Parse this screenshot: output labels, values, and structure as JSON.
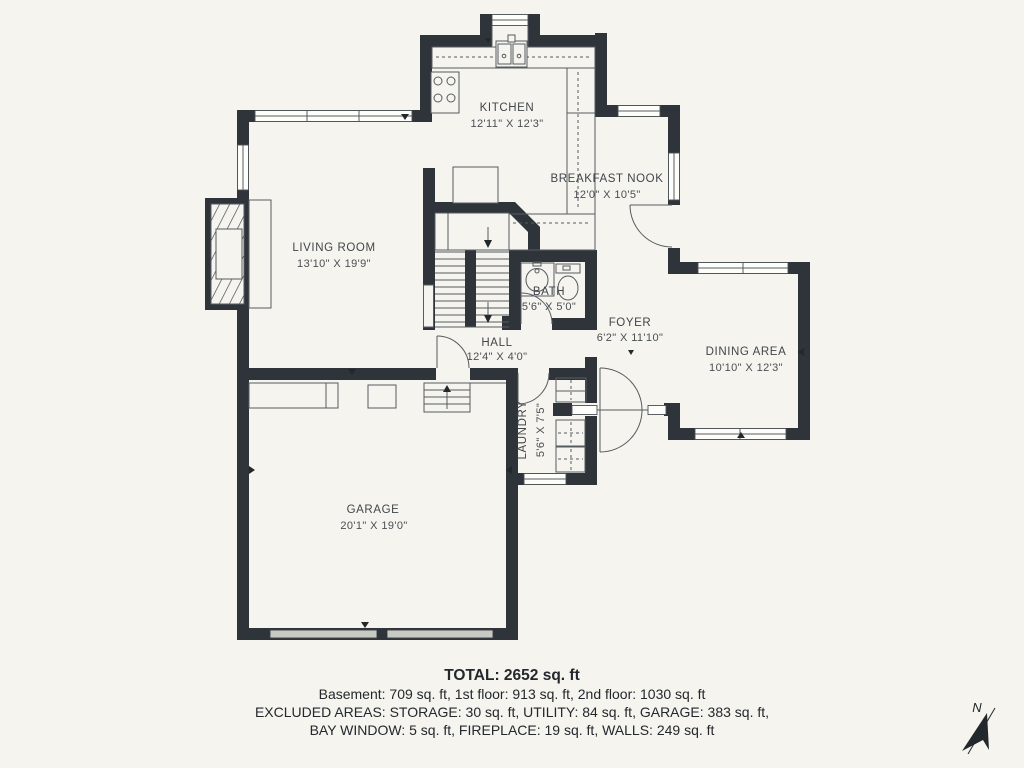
{
  "colors": {
    "background": "#f5f4ee",
    "walls": "#2f343a",
    "thin_lines": "#565b60",
    "text": "#41464b",
    "garage_door": "#c9c9c3"
  },
  "rooms": {
    "kitchen": {
      "name": "KITCHEN",
      "dims": "12'11\" X 12'3\""
    },
    "breakfast_nook": {
      "name": "BREAKFAST NOOK",
      "dims": "12'0\" X 10'5\""
    },
    "living_room": {
      "name": "LIVING ROOM",
      "dims": "13'10\" X 19'9\""
    },
    "bath": {
      "name": "BATH",
      "dims": "5'6\" X 5'0\""
    },
    "hall": {
      "name": "HALL",
      "dims": "12'4\" X 4'0\""
    },
    "foyer": {
      "name": "FOYER",
      "dims": "6'2\" X 11'10\""
    },
    "dining_area": {
      "name": "DINING AREA",
      "dims": "10'10\" X 12'3\""
    },
    "laundry": {
      "name": "LAUNDRY",
      "dims": "5'6\" X 7'5\""
    },
    "garage": {
      "name": "GARAGE",
      "dims": "20'1\" X 19'0\""
    }
  },
  "summary": {
    "total": "TOTAL: 2652 sq. ft",
    "floors": "Basement: 709 sq. ft, 1st floor: 913 sq. ft, 2nd floor: 1030 sq. ft",
    "excluded_line1": "EXCLUDED AREAS: STORAGE: 30 sq. ft, UTILITY: 84 sq. ft, GARAGE: 383 sq. ft,",
    "excluded_line2": "BAY WINDOW: 5 sq. ft, FIREPLACE: 19 sq. ft, WALLS: 249 sq. ft"
  },
  "compass": {
    "label": "N"
  }
}
